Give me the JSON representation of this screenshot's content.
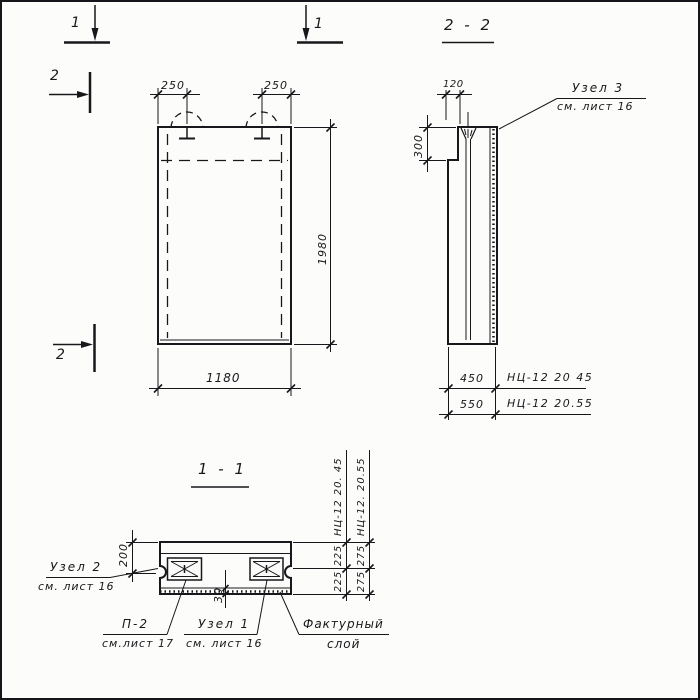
{
  "colors": {
    "ink": "#18181c",
    "paper": "#fcfcfa"
  },
  "markers": {
    "sec1": "1",
    "sec2": "2"
  },
  "front_view": {
    "dim_250_left": "250",
    "dim_250_right": "250",
    "dim_1980": "1980",
    "dim_1180": "1180"
  },
  "section_2_2": {
    "title": "2 - 2",
    "dim_120": "120",
    "dim_300": "300",
    "dim_450": "450",
    "dim_550": "550",
    "mark_450": "НЦ-12 20 45",
    "mark_550": "НЦ-12 20.55",
    "node3": "Узел 3",
    "node3_ref": "см. лист 16"
  },
  "section_1_1": {
    "title": "1 - 1",
    "dim_200": "200",
    "dim_30": "30",
    "col45": {
      "label": "НЦ-12 20. 45",
      "d1": "225",
      "d2": "225"
    },
    "col55": {
      "label": "НЦ-12. 20.55",
      "d1": "275",
      "d2": "275"
    },
    "node2": "Узел 2",
    "node2_ref": "см. лист 16",
    "p2": "П-2",
    "p2_ref": "см.лист 17",
    "node1": "Узел 1",
    "node1_ref": "см. лист 16",
    "texture1": "Фактурный",
    "texture2": "слой"
  }
}
